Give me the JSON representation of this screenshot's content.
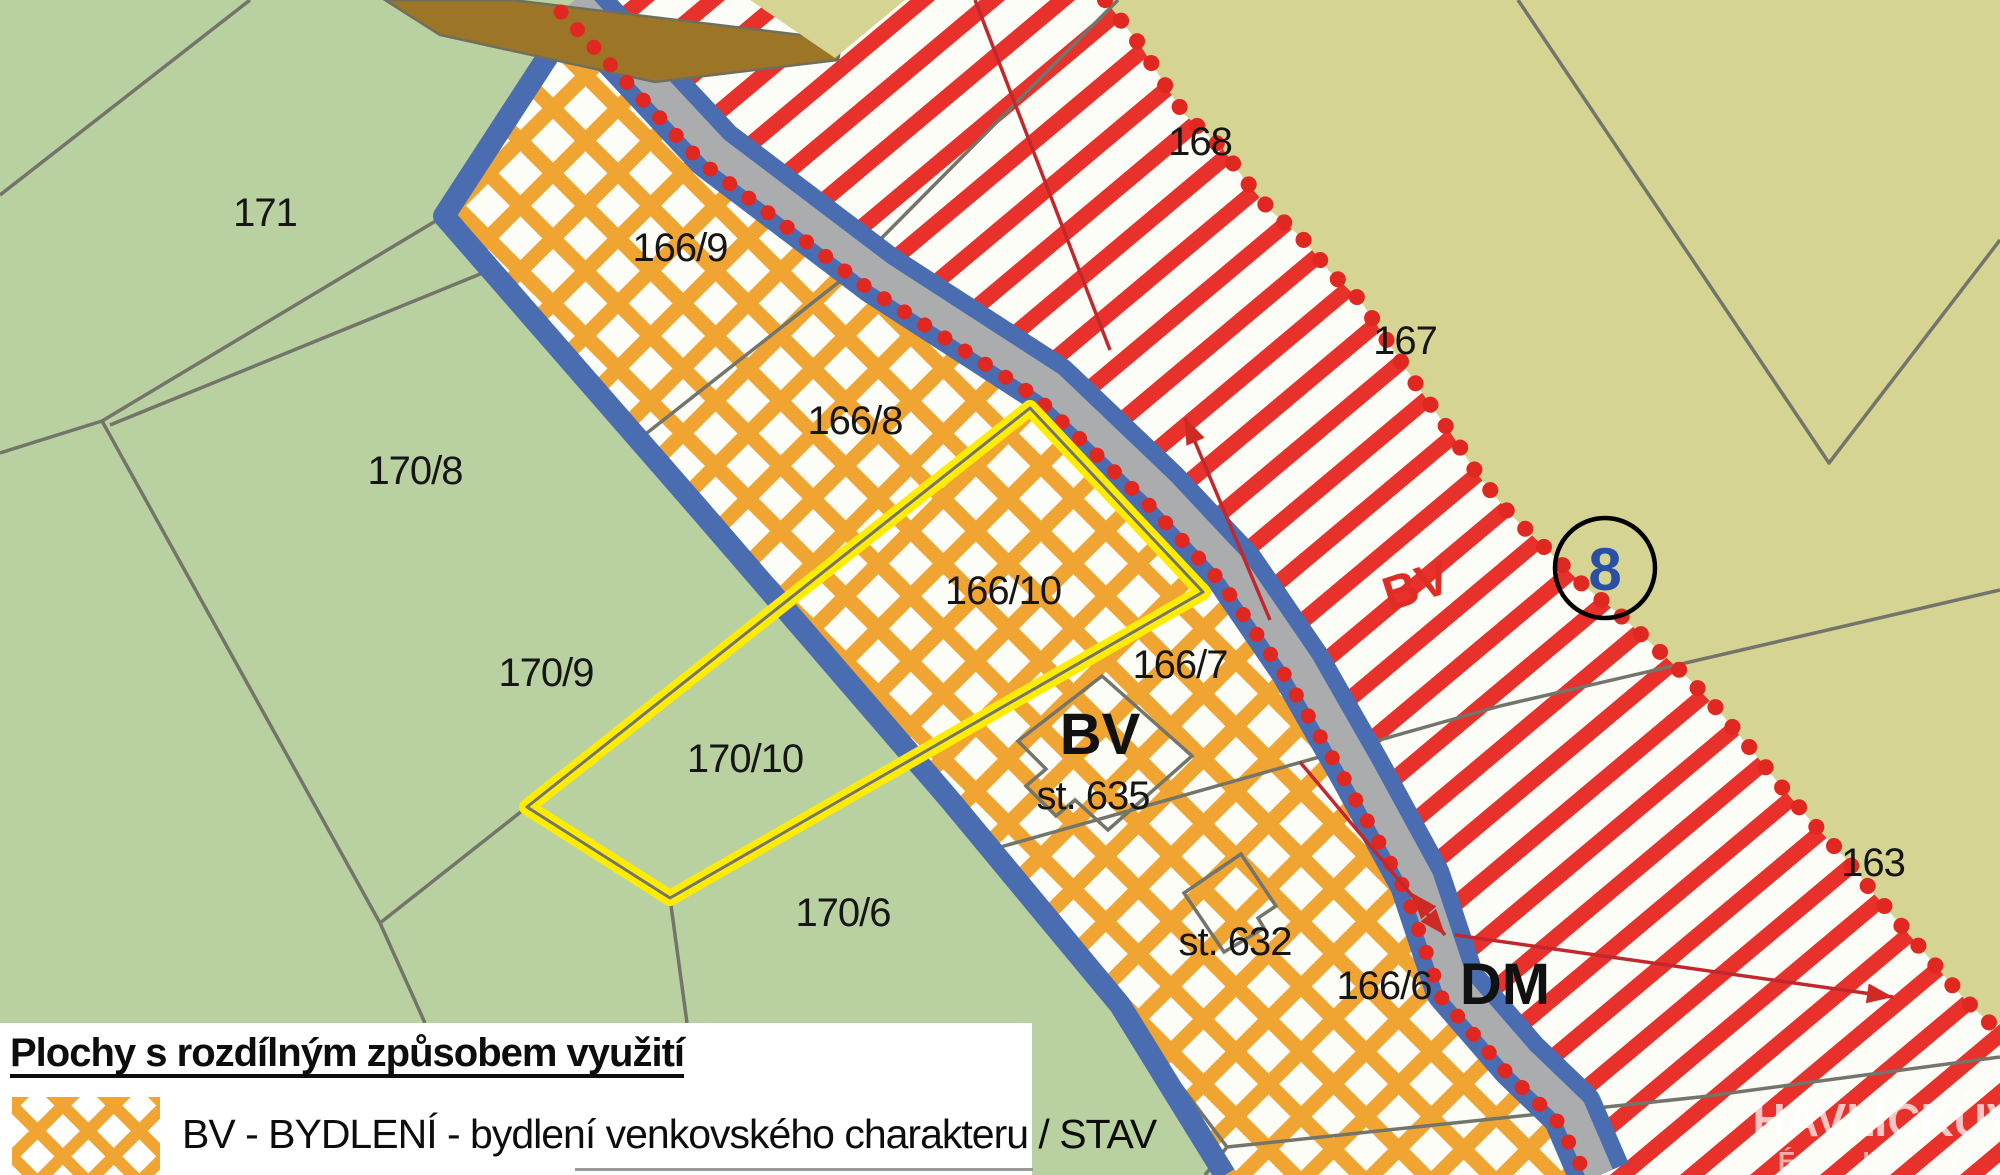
{
  "legend": {
    "title": "Plochy s rozdílným způsobem využití",
    "items": [
      {
        "swatch": "bv-orange-lattice",
        "label": "BV - BYDLENÍ - bydlení venkovského charakteru / STAV"
      }
    ]
  },
  "labels": {
    "l171": "171",
    "l166_9": "166/9",
    "l170_8": "170/8",
    "l166_8": "166/8",
    "l166_10": "166/10",
    "l170_9": "170/9",
    "l166_7": "166/7",
    "l170_10": "170/10",
    "l170_6": "170/6",
    "st635": "st. 635",
    "st632": "st. 632",
    "l166_6": "166/6",
    "l167": "167",
    "l168": "168",
    "l163": "163",
    "bv_zone_black": "BV",
    "bv_zone_red": "BV",
    "dm_zone": "DM",
    "circle_number": "8"
  },
  "watermark": {
    "line1": "HAVLÍČKŮV",
    "line2": "É L Y"
  },
  "colors": {
    "green_area": "#b9d1a1",
    "olive_area": "#d5d493",
    "pattern_bg": "#fdfdf7",
    "orange_lattice": "#f0a532",
    "red_stripe": "#e8312b",
    "road_gray": "#abacae",
    "border_blue": "#4a6db1",
    "parcel_line_gray": "#73746a",
    "highlight_yellow": "#ffec00",
    "dot_red": "#e02820",
    "annotation_red": "#c1272d",
    "brown_road": "#9d7527",
    "circle_number_blue": "#2950a5"
  }
}
